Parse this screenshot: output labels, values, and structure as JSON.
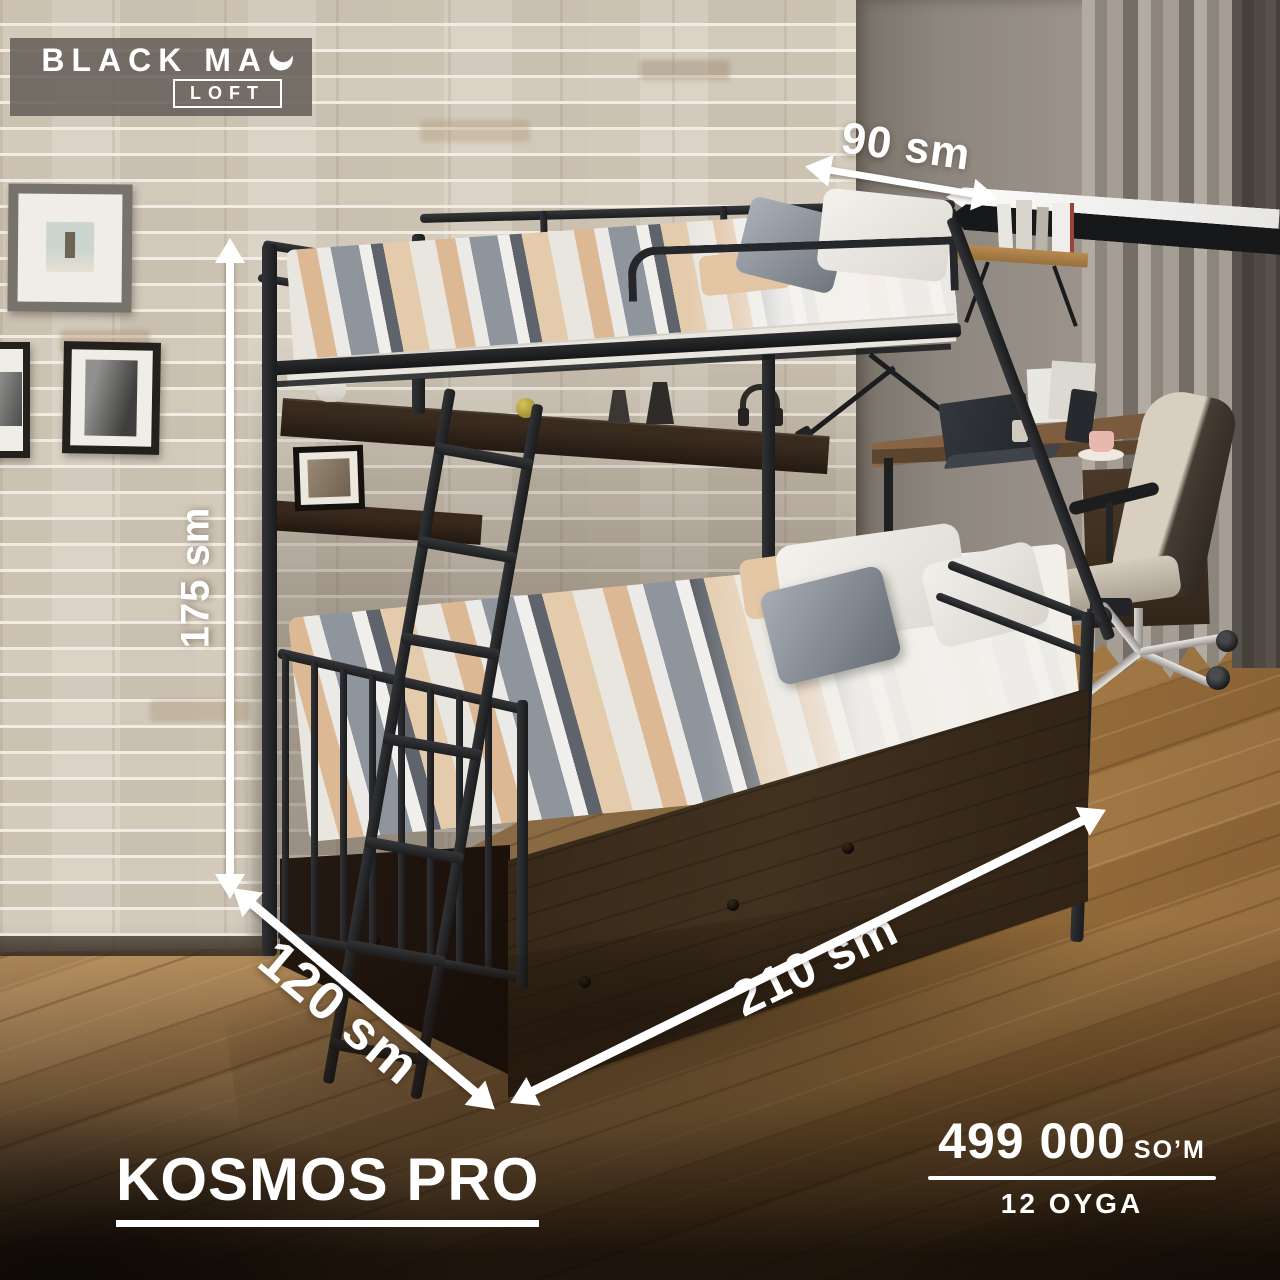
{
  "brand": {
    "name": "BLACK MA",
    "badge": "LOFT",
    "icon": "crescent-moon"
  },
  "product": {
    "name": "KOSMOS PRO"
  },
  "price": {
    "amount": "499 000",
    "currency": "SO’M",
    "term": "12 OYGA"
  },
  "dimensions": {
    "height": {
      "label": "175 sm"
    },
    "depth": {
      "label": "120 sm"
    },
    "length": {
      "label": "210 sm"
    },
    "shelf": {
      "label": "90 sm"
    }
  },
  "scene": {
    "description": "Black metal bunk bed with dark wood drawers in a room: white brick wall, gray wall, curtains, desk with chair, wall shelves, wooden floor"
  },
  "colors": {
    "annotation": "#ffffff",
    "logo_plate": "rgba(99,93,87,0.86)",
    "bed_frame": "#232427",
    "drawer_wood": "#3a2c1d",
    "brick": "#d9d2c5",
    "floor": "#b08a57"
  }
}
